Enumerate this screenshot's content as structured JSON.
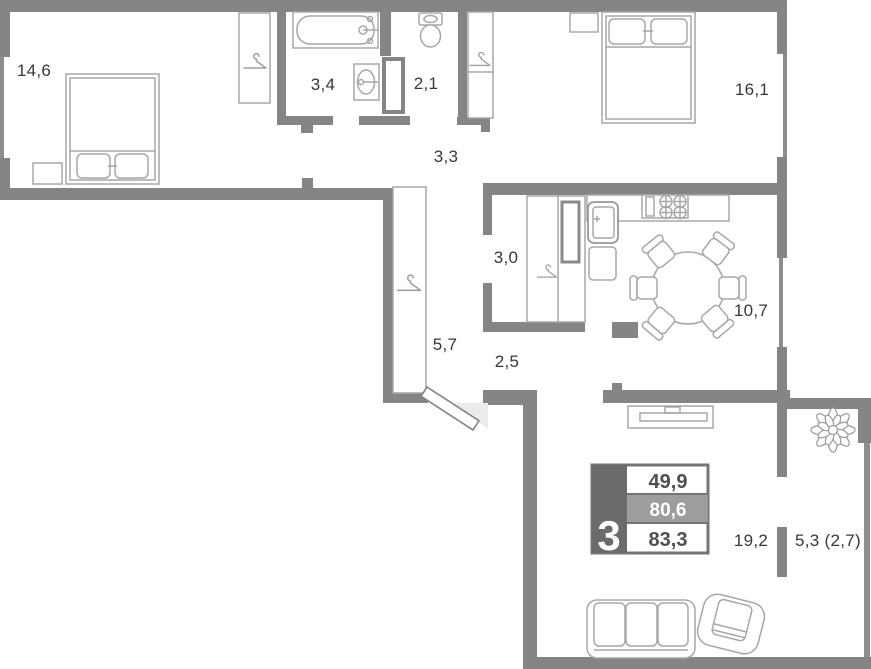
{
  "plan": {
    "title": "3-room apartment floor plan",
    "rooms": {
      "bedroom1": "14,6",
      "bathroom": "3,4",
      "wc": "2,1",
      "bedroom2": "16,1",
      "corridor": "3,3",
      "hall": "3,0",
      "kitchen": "10,7",
      "wardrobe": "5,7",
      "entry": "2,5",
      "living": "19,2",
      "balcony": "5,3 (2,7)"
    },
    "stats": {
      "rooms_count": "3",
      "living_area": "49,9",
      "area_without_balcony": "80,6",
      "total_area": "83,3"
    },
    "icons": [
      "hanger-icon",
      "plant-icon"
    ],
    "colors": {
      "wall": "#858585",
      "furniture_line": "#a7a7a7",
      "label_text": "#383838",
      "stat_dark": "#6b6b6b",
      "stat_mid": "#9d9d9d",
      "stat_text": "#4f4f4f"
    }
  }
}
